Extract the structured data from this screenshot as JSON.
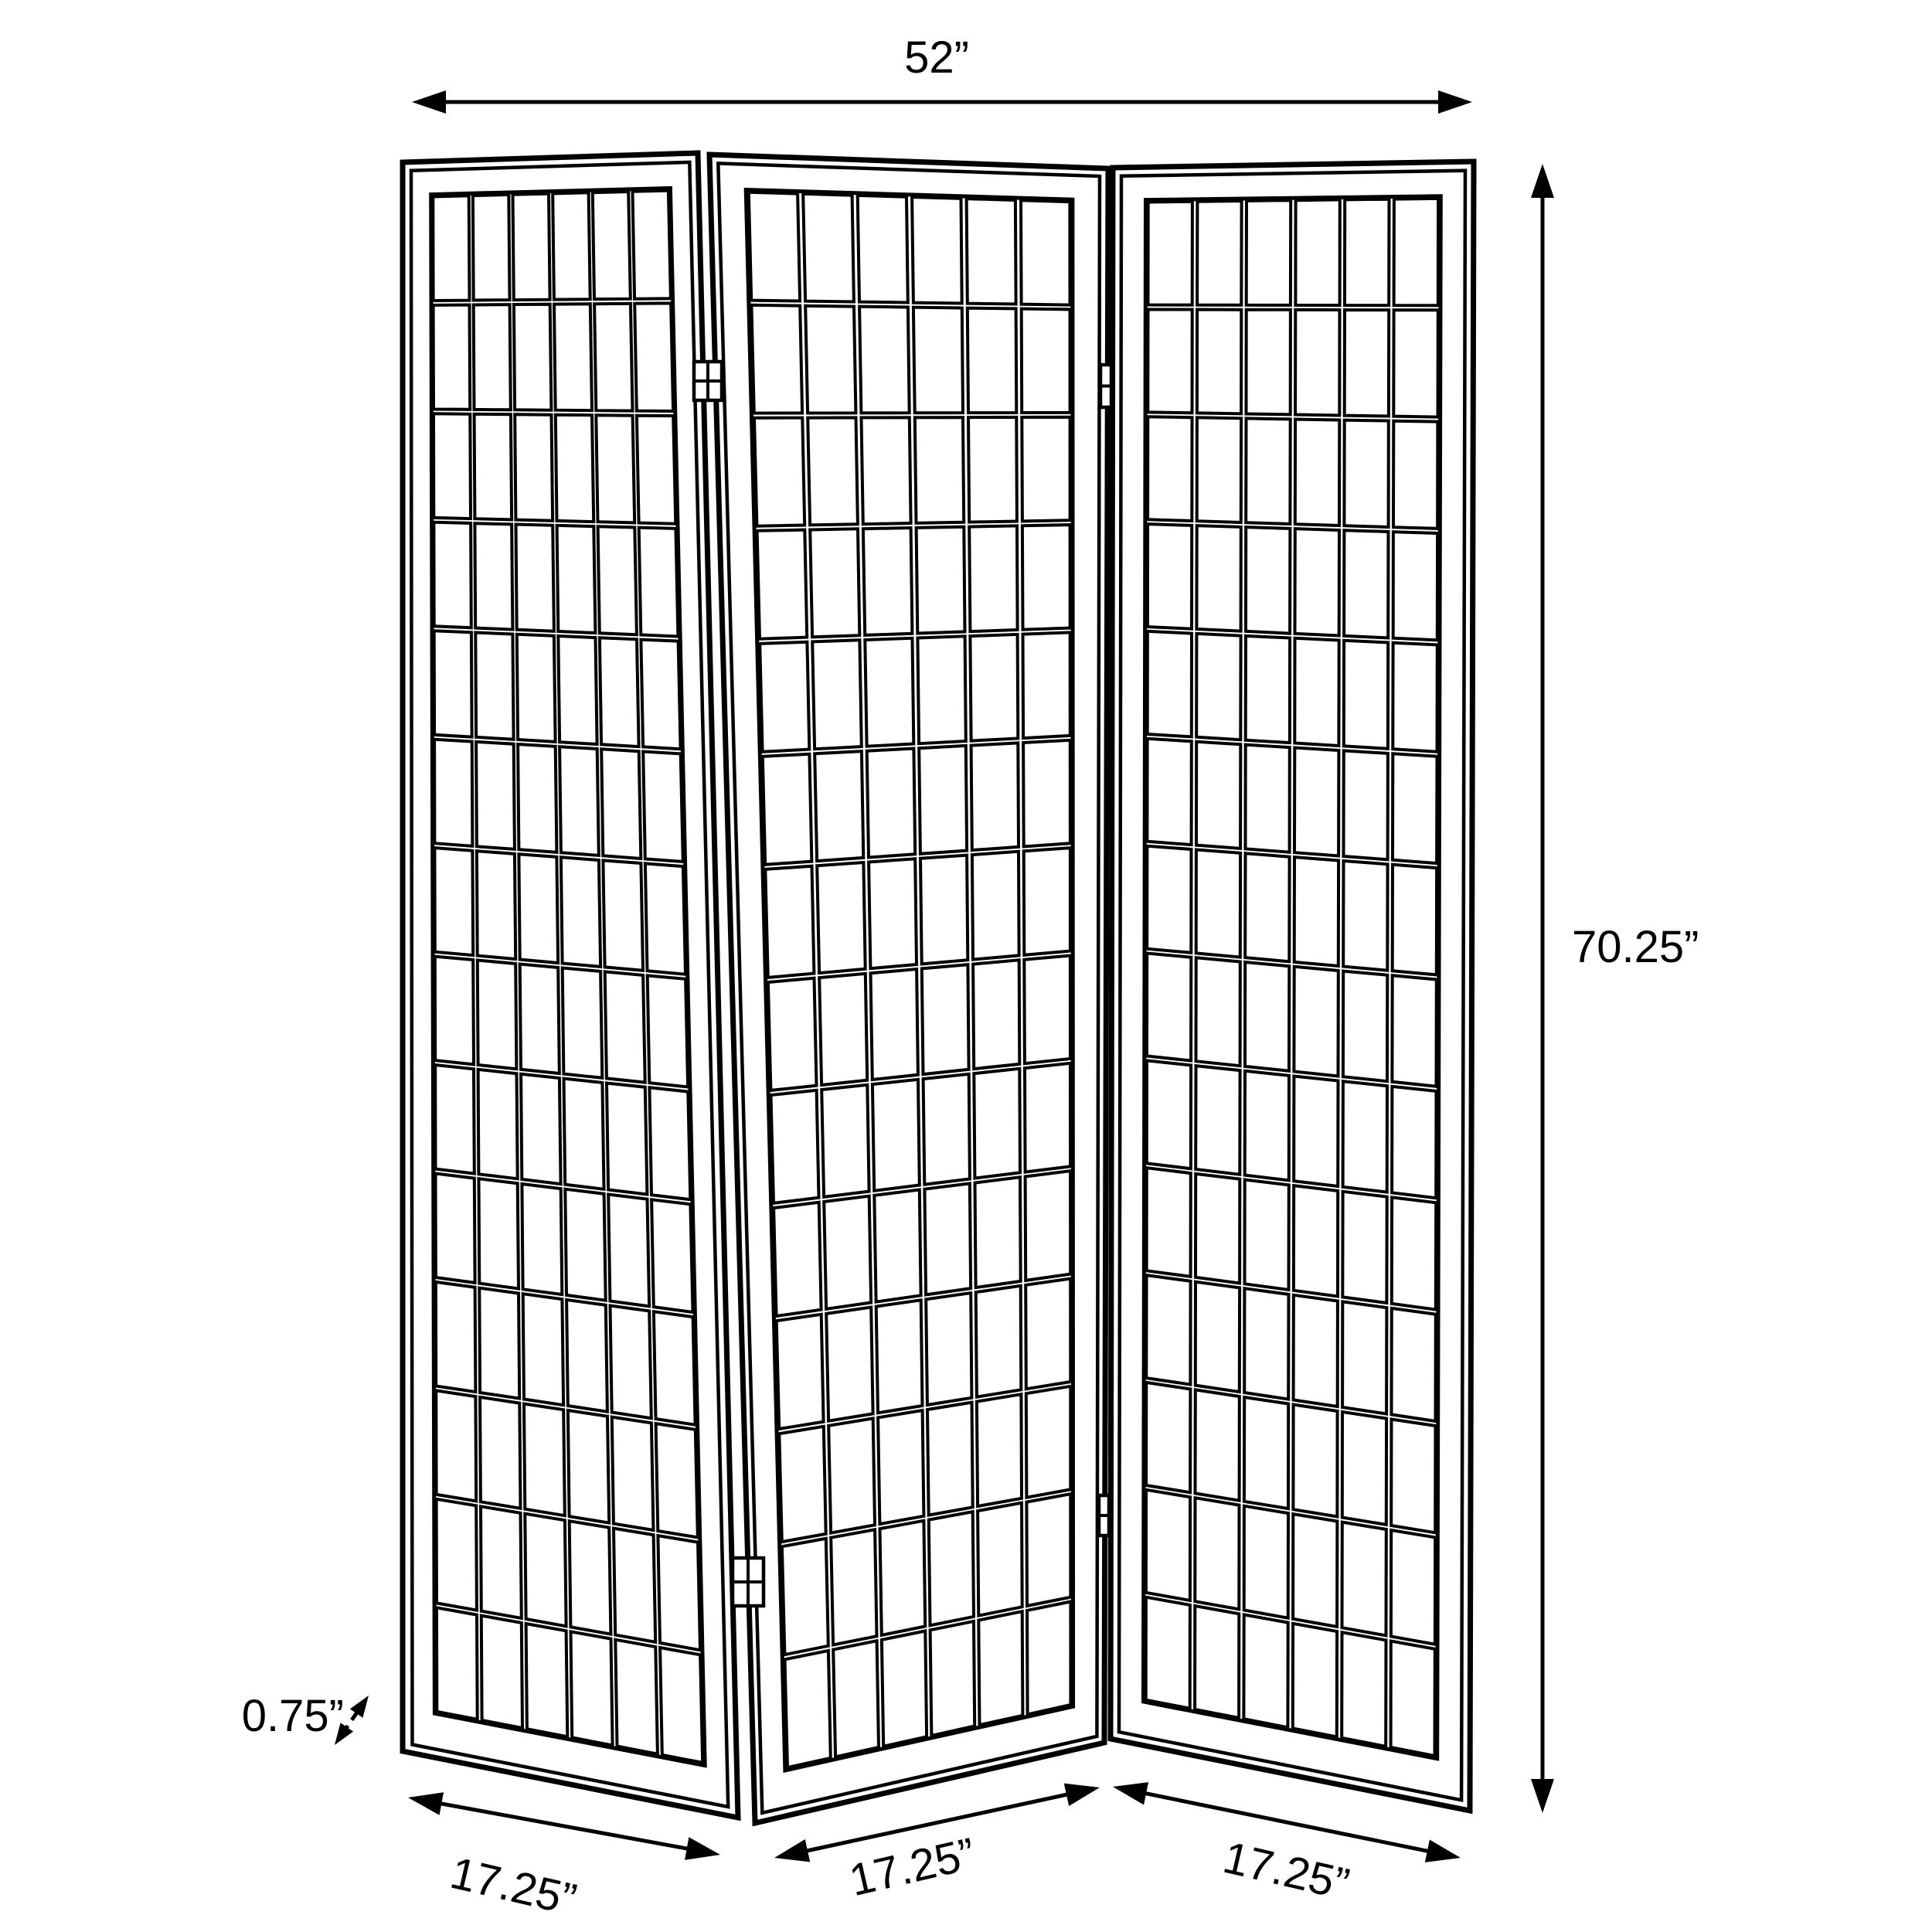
{
  "page": {
    "background": "#ffffff",
    "line_color": "#000000"
  },
  "figure": {
    "title": "Three-panel folding screen dimension diagram",
    "product": "3-panel shoji-style folding room divider, line drawing with dimensions",
    "panel_count": 3,
    "grid_columns": 6,
    "grid_rows": 14,
    "hinge_pairs": 2
  },
  "annotations": {
    "width": {
      "label": "52”",
      "value_inches": 52
    },
    "height": {
      "label": "70.25”",
      "value_inches": 70.25
    },
    "thickness": {
      "label": "0.75”",
      "value_inches": 0.75
    },
    "panels": [
      {
        "label": "17.25”",
        "value_inches": 17.25
      },
      {
        "label": "17.25”",
        "value_inches": 17.25
      },
      {
        "label": "17.25”",
        "value_inches": 17.25
      }
    ]
  }
}
